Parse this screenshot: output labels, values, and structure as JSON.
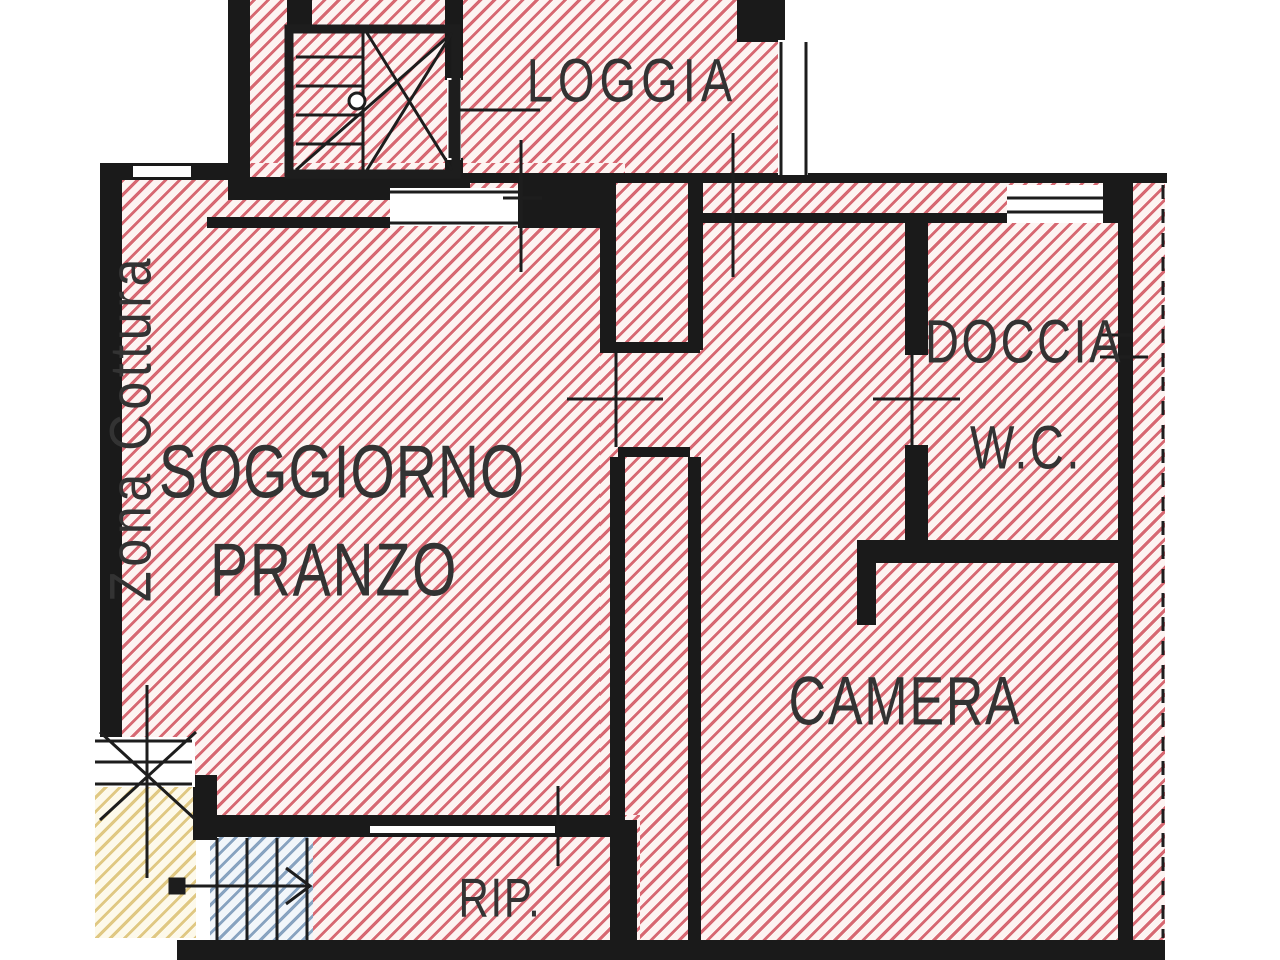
{
  "plan": {
    "rooms": [
      {
        "id": "loggia",
        "label": "LOGGIA"
      },
      {
        "id": "soggiorno-pranzo",
        "line1": "SOGGIORNO",
        "line2": "PRANZO"
      },
      {
        "id": "zona-cottura",
        "label": "Zona Cottura"
      },
      {
        "id": "camera",
        "label": "CAMERA"
      },
      {
        "id": "doccia-wc",
        "line1": "DOCCIA",
        "line2": "W.C."
      },
      {
        "id": "ripostiglio",
        "label": "RIP."
      }
    ],
    "colors": {
      "unit_hatch": "#d0505c",
      "exterior_hatch": "#d6b860",
      "stairs_hatch": "#6e8eb2",
      "wall": "#1a1a1a",
      "label": "#333333",
      "background": "#ffffff"
    }
  }
}
